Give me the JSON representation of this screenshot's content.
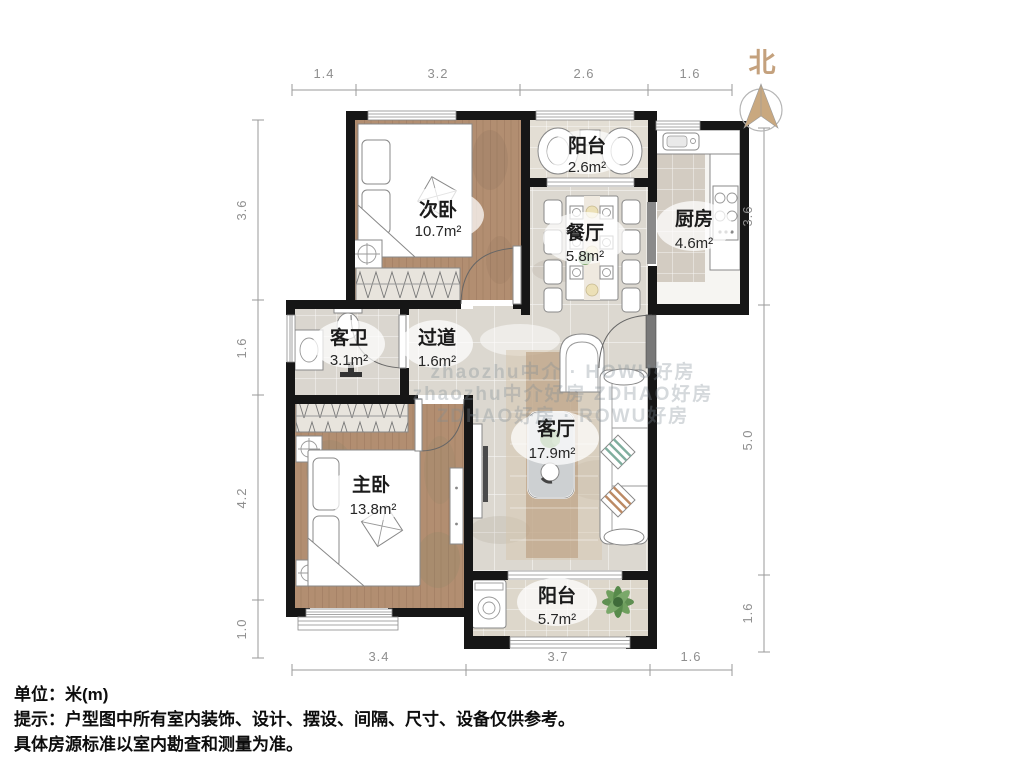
{
  "north": {
    "label": "北"
  },
  "rooms": [
    {
      "name": "次卧",
      "area": "10.7m²"
    },
    {
      "name": "阳台",
      "area": "2.6m²"
    },
    {
      "name": "餐厅",
      "area": "5.8m²"
    },
    {
      "name": "厨房",
      "area": "4.6m²"
    },
    {
      "name": "客卫",
      "area": "3.1m²"
    },
    {
      "name": "过道",
      "area": "1.6m²"
    },
    {
      "name": "客厅",
      "area": "17.9m²"
    },
    {
      "name": "主卧",
      "area": "13.8m²"
    },
    {
      "name": "阳台",
      "area": "5.7m²"
    }
  ],
  "dimensions": {
    "top": [
      "1.4",
      "3.2",
      "2.6",
      "1.6"
    ],
    "left": [
      "3.6",
      "1.6",
      "4.2",
      "1.0"
    ],
    "right": [
      "3.6",
      "5.0",
      "1.6"
    ],
    "bottom": [
      "3.4",
      "3.7",
      "1.6"
    ]
  },
  "watermark": {
    "line1": "zhaozhu中介 · HOWU好房",
    "line2": "zhaozhu中介好房 ZDHAO好房",
    "line3": "ZDHAO好房 · ROWU好房"
  },
  "footer": {
    "unit": "单位：米(m)",
    "note1": "提示：户型图中所有室内装饰、设计、摆设、间隔、尺寸、设备仅供参考。",
    "note2": "具体房源标准以室内勘查和测量为准。"
  },
  "colors": {
    "wall": "#161616",
    "wood_floor": "#b28e71",
    "tile_floor": "#dcd8d0",
    "north_accent": "#c4a17d",
    "dimension": "#8f8f8f"
  }
}
